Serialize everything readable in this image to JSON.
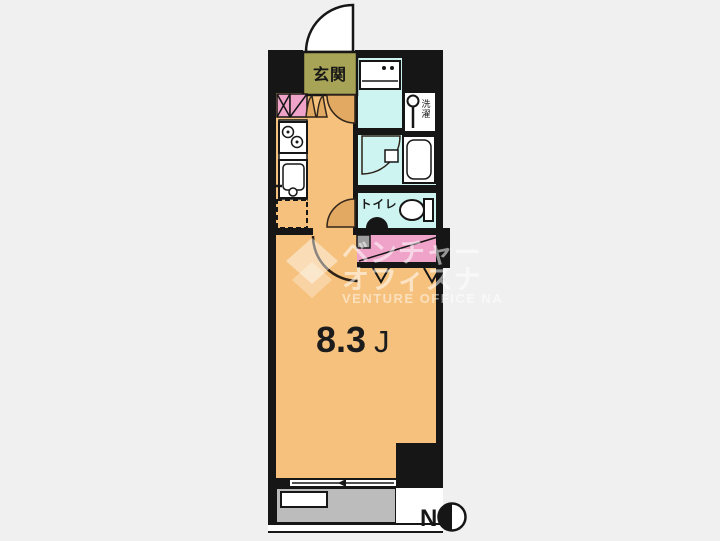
{
  "floorplan": {
    "labels": {
      "genkan": "玄関",
      "toilet": "トイレ",
      "laundry_char1": "洗",
      "laundry_char2": "濯",
      "room_size": "8.3",
      "room_size_unit": "J",
      "compass_north": "N"
    },
    "watermark": {
      "line1": "ベンチャー",
      "line2": "オフィスナ",
      "line3": "VENTURE OFFICE NA"
    },
    "colors": {
      "background": "#f0f0f0",
      "wall": "#161616",
      "room_orange": "#f6c17d",
      "genkan_olive": "#a8a457",
      "wet_area_cyan": "#cdf4f1",
      "closet_pink": "#f0a3c8",
      "balcony_gray": "#bcbcbc",
      "pipe_gray": "#9e9e9e",
      "door_tan": "#e2a963",
      "fixture_white": "#ffffff"
    }
  }
}
